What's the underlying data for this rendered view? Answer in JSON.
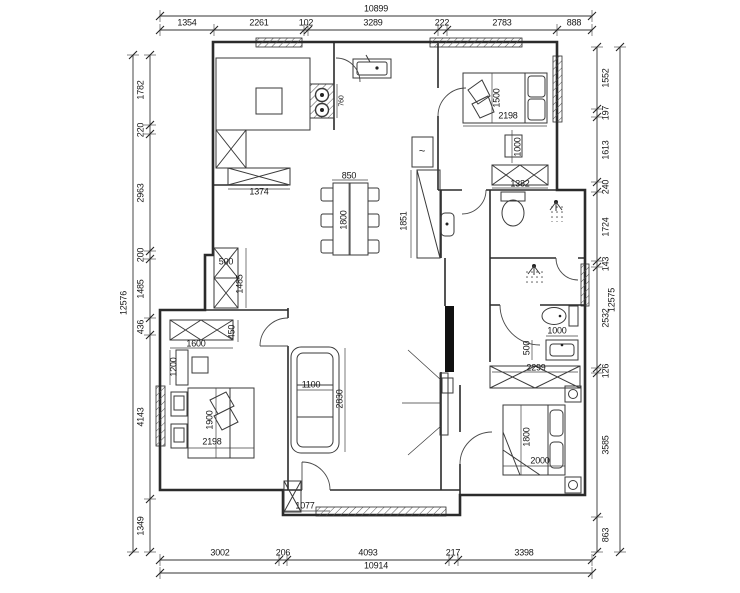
{
  "drawing": {
    "type": "architectural-floor-plan",
    "background_color": "#ffffff",
    "wall_color": "#2b2b2b",
    "dim_text_color": "#161616",
    "units": "mm"
  },
  "dimension_chains": [
    {
      "id": "top-total",
      "dir": "h",
      "line": {
        "a": 160,
        "b": 592,
        "pos": 16
      },
      "lo": -7,
      "ticks": [
        160,
        592
      ],
      "labels": [
        {
          "t": "10899",
          "c": 376
        }
      ]
    },
    {
      "id": "top-segments",
      "dir": "h",
      "line": {
        "a": 160,
        "b": 592,
        "pos": 30
      },
      "lo": -7,
      "ticks": [
        160,
        214,
        304,
        308,
        438,
        447,
        557,
        592
      ],
      "labels": [
        {
          "t": "1354",
          "c": 187
        },
        {
          "t": "2261",
          "c": 259
        },
        {
          "t": "102",
          "c": 306
        },
        {
          "t": "3289",
          "c": 373
        },
        {
          "t": "222",
          "c": 442
        },
        {
          "t": "2783",
          "c": 502
        },
        {
          "t": "888",
          "c": 574
        }
      ]
    },
    {
      "id": "bottom-segments",
      "dir": "h",
      "line": {
        "a": 160,
        "b": 592,
        "pos": 560
      },
      "lo": -7,
      "ticks": [
        160,
        279,
        287,
        449,
        458,
        592
      ],
      "labels": [
        {
          "t": "3002",
          "c": 220
        },
        {
          "t": "206",
          "c": 283
        },
        {
          "t": "4093",
          "c": 368
        },
        {
          "t": "217",
          "c": 453
        },
        {
          "t": "3398",
          "c": 524
        }
      ]
    },
    {
      "id": "bottom-total",
      "dir": "h",
      "line": {
        "a": 160,
        "b": 592,
        "pos": 573
      },
      "lo": -7,
      "ticks": [
        160,
        592
      ],
      "labels": [
        {
          "t": "10914",
          "c": 376
        }
      ]
    },
    {
      "id": "left-total",
      "dir": "v",
      "line": {
        "a": 55,
        "b": 552,
        "pos": 133
      },
      "lo": -9,
      "ticks": [
        55,
        552
      ],
      "labels": [
        {
          "t": "12576",
          "c": 303
        }
      ]
    },
    {
      "id": "left-segments",
      "dir": "v",
      "line": {
        "a": 55,
        "b": 552,
        "pos": 150
      },
      "lo": -9,
      "ticks": [
        55,
        125,
        134,
        251,
        259,
        318,
        335,
        499,
        552
      ],
      "labels": [
        {
          "t": "1782",
          "c": 90
        },
        {
          "t": "220",
          "c": 130
        },
        {
          "t": "2963",
          "c": 193
        },
        {
          "t": "200",
          "c": 255
        },
        {
          "t": "1485",
          "c": 289
        },
        {
          "t": "436",
          "c": 327
        },
        {
          "t": "4143",
          "c": 417
        },
        {
          "t": "1349",
          "c": 526
        }
      ]
    },
    {
      "id": "right-segments",
      "dir": "v",
      "line": {
        "a": 47,
        "b": 552,
        "pos": 597
      },
      "lo": 9,
      "ticks": [
        47,
        109,
        117,
        182,
        192,
        261,
        267,
        368,
        373,
        517,
        552
      ],
      "labels": [
        {
          "t": "1552",
          "c": 78
        },
        {
          "t": "197",
          "c": 113
        },
        {
          "t": "1613",
          "c": 150
        },
        {
          "t": "240",
          "c": 187
        },
        {
          "t": "1724",
          "c": 227
        },
        {
          "t": "143",
          "c": 264
        },
        {
          "t": "2532",
          "c": 318
        },
        {
          "t": "126",
          "c": 371
        },
        {
          "t": "3585",
          "c": 445
        },
        {
          "t": "863",
          "c": 535
        }
      ]
    },
    {
      "id": "right-total",
      "dir": "v",
      "line": {
        "a": 47,
        "b": 552,
        "pos": 620
      },
      "lo": -8,
      "ticks": [
        47,
        552
      ],
      "labels": [
        {
          "t": "12575",
          "c": 300
        }
      ]
    }
  ],
  "interior_dimensions": [
    {
      "t": "1374",
      "x": 259,
      "y": 192
    },
    {
      "t": "850",
      "x": 349,
      "y": 176
    },
    {
      "t": "1800",
      "x": 344,
      "y": 220,
      "v": 1
    },
    {
      "t": "1851",
      "x": 404,
      "y": 221,
      "v": 1
    },
    {
      "t": "760",
      "x": 342,
      "y": 101,
      "v": 1,
      "small": 1
    },
    {
      "t": "1500",
      "x": 497,
      "y": 98,
      "v": 1
    },
    {
      "t": "2198",
      "x": 508,
      "y": 116
    },
    {
      "t": "1000",
      "x": 518,
      "y": 147,
      "v": 1
    },
    {
      "t": "1382",
      "x": 520,
      "y": 184
    },
    {
      "t": "1000",
      "x": 557,
      "y": 331
    },
    {
      "t": "500",
      "x": 527,
      "y": 348,
      "v": 1
    },
    {
      "t": "2299",
      "x": 536,
      "y": 368
    },
    {
      "t": "1800",
      "x": 527,
      "y": 437,
      "v": 1
    },
    {
      "t": "2000",
      "x": 540,
      "y": 461
    },
    {
      "t": "500",
      "x": 226,
      "y": 262
    },
    {
      "t": "1485",
      "x": 240,
      "y": 284,
      "v": 1
    },
    {
      "t": "1600",
      "x": 196,
      "y": 344
    },
    {
      "t": "450",
      "x": 232,
      "y": 332,
      "v": 1
    },
    {
      "t": "1200",
      "x": 174,
      "y": 367,
      "v": 1
    },
    {
      "t": "1900",
      "x": 210,
      "y": 420,
      "v": 1
    },
    {
      "t": "2198",
      "x": 212,
      "y": 442
    },
    {
      "t": "1100",
      "x": 311,
      "y": 385
    },
    {
      "t": "2830",
      "x": 340,
      "y": 399,
      "v": 1
    },
    {
      "t": "1077",
      "x": 305,
      "y": 506
    }
  ],
  "fixture_labels": [
    {
      "t": "~",
      "x": 422,
      "y": 152,
      "fixture": 1
    }
  ]
}
